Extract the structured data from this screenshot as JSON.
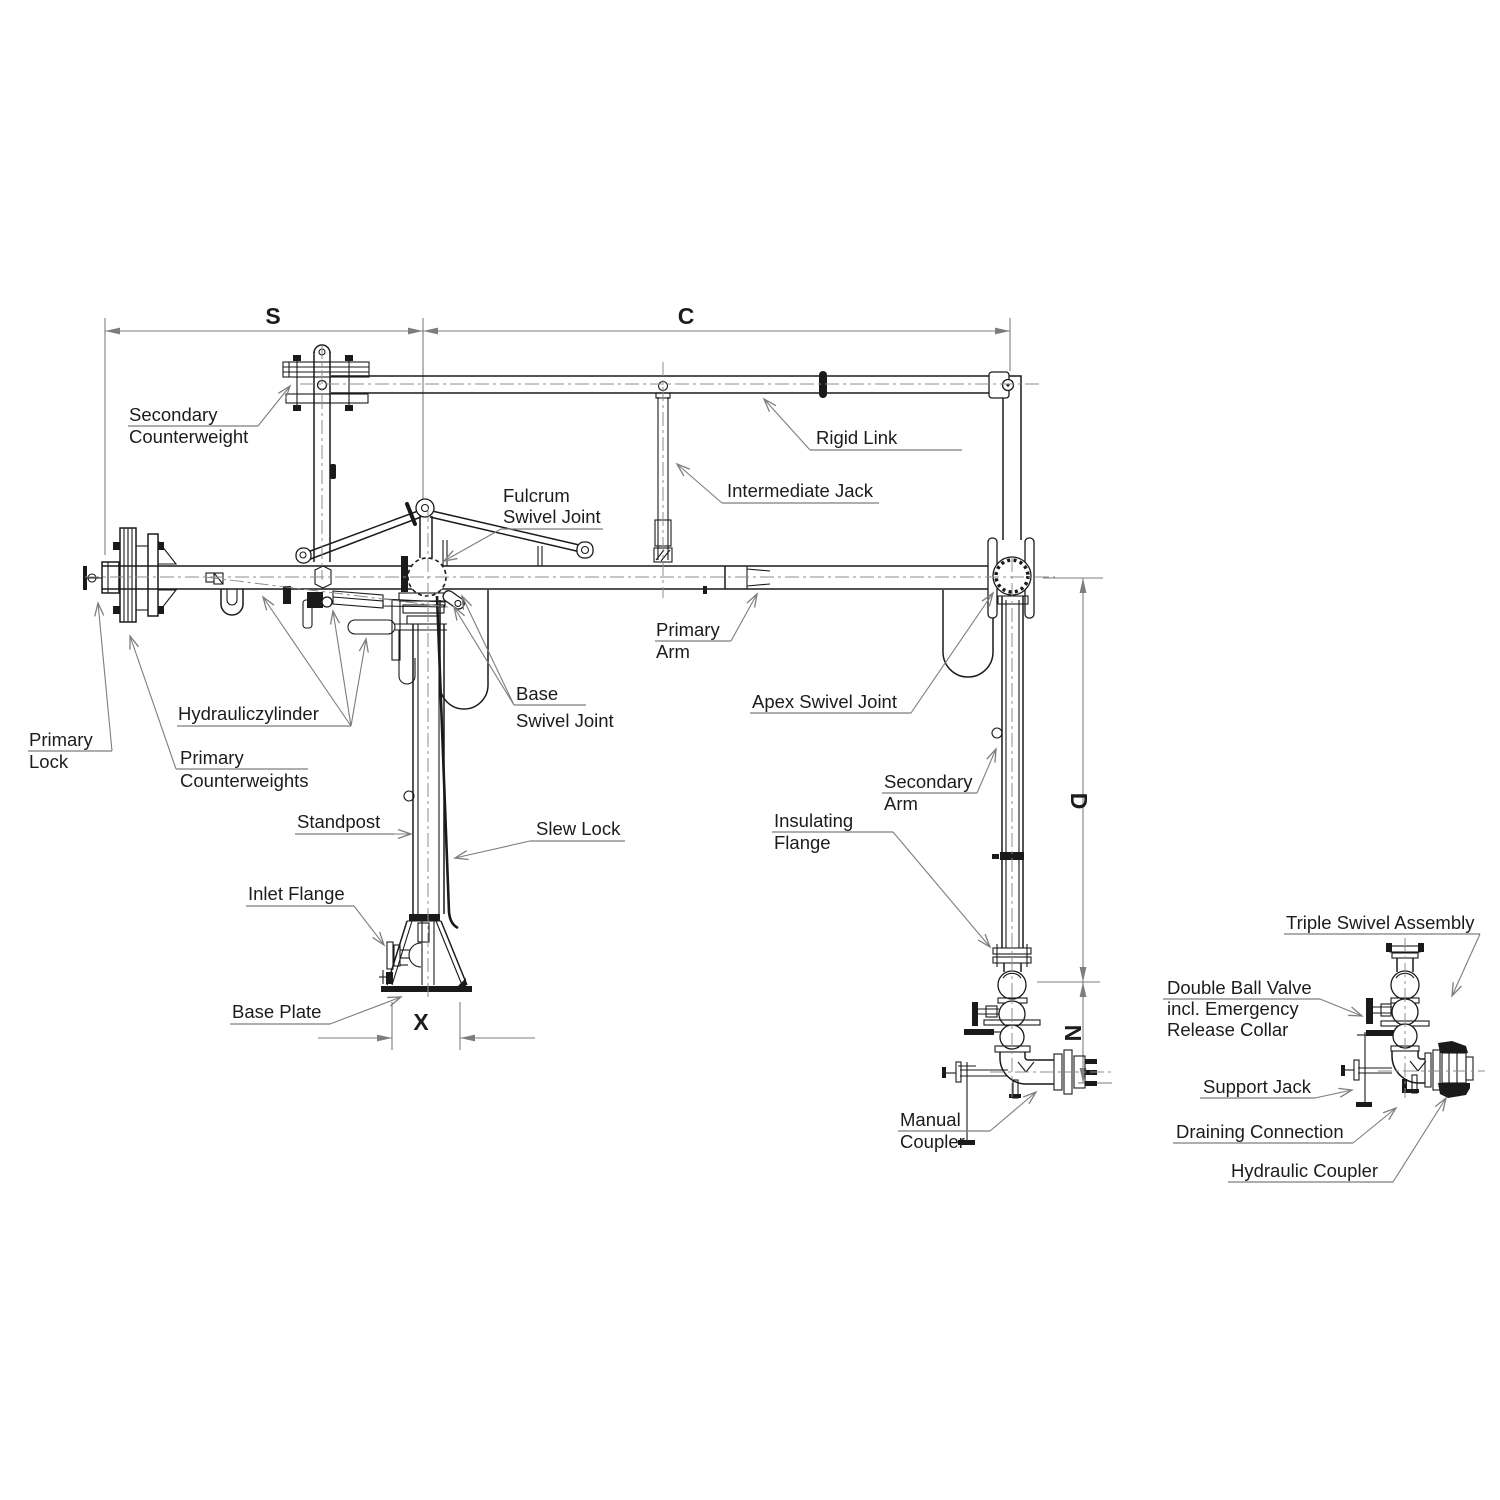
{
  "labels": {
    "secondary_counterweight": [
      "Secondary",
      "Counterweight"
    ],
    "rigid_link": [
      "Rigid Link"
    ],
    "intermediate_jack": [
      "Intermediate Jack"
    ],
    "fulcrum_swivel_joint": [
      "Fulcrum",
      "Swivel Joint"
    ],
    "base_swivel_joint": [
      "Base",
      "Swivel Joint"
    ],
    "primary_arm": [
      "Primary",
      "Arm"
    ],
    "apex_swivel_joint": [
      "Apex Swivel Joint"
    ],
    "hydrauliczylinder": [
      "Hydrauliczylinder"
    ],
    "primary_lock": [
      "Primary",
      "Lock"
    ],
    "primary_counterweights": [
      "Primary",
      "Counterweights"
    ],
    "standpost": [
      "Standpost"
    ],
    "slew_lock": [
      "Slew Lock"
    ],
    "inlet_flange": [
      "Inlet Flange"
    ],
    "base_plate": [
      "Base Plate"
    ],
    "secondary_arm": [
      "Secondary",
      "Arm"
    ],
    "insulating_flange": [
      "Insulating",
      "Flange"
    ],
    "manual_coupler": [
      "Manual",
      "Coupler"
    ],
    "triple_swivel_assembly": [
      "Triple Swivel Assembly"
    ],
    "double_ball_valve": [
      "Double Ball Valve",
      "incl. Emergency",
      "Release Collar"
    ],
    "support_jack": [
      "Support Jack"
    ],
    "draining_connection": [
      "Draining Connection"
    ],
    "hydraulic_coupler": [
      "Hydraulic Coupler"
    ]
  },
  "dimensions": {
    "span_s": "S",
    "span_c": "C",
    "height_d": "D",
    "height_n": "N",
    "width_x": "X"
  },
  "colors": {
    "line": "#1a1a1a",
    "leader": "#7d7d7d",
    "background": "#ffffff"
  }
}
